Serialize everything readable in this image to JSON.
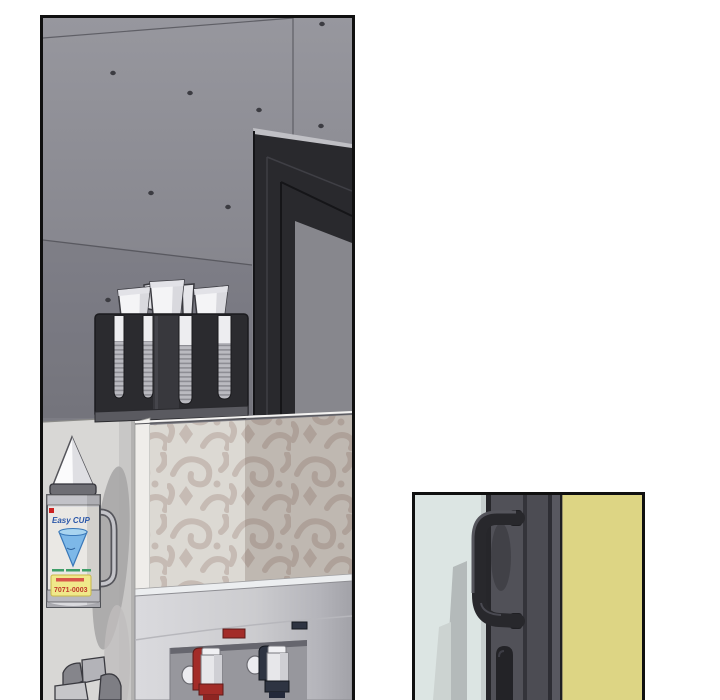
{
  "dispenser": {
    "brand": "Easy CUP",
    "phone": "7071-0003"
  },
  "colors": {
    "panel_border": "#101010",
    "concrete_top": "#97979e",
    "concrete_bottom": "#7b7b83",
    "lower_wall": "#d8d7d5",
    "door_frame_dark": "#29292d",
    "door_glass": "#87878d",
    "holder_dark": "#2b2b2f",
    "cup_white": "#f4f4f6",
    "rib_light": "#babac0",
    "rib_dark": "#8d8d94",
    "pattern_bg": "#dcd9d3",
    "pattern_motif": "#c6bbb4",
    "cooler_face_light": "#dadade",
    "cooler_face_dark": "#aeaeb4",
    "alcove_gray": "#97979d",
    "hot_red": "#a32c28",
    "cold_navy": "#2e3442",
    "right_glass": "#dce5e3",
    "right_frame": "#4a4a50",
    "handle_dark": "#28282c",
    "yellow_wall": "#ddd584",
    "label_blue": "#2a56a8",
    "sticker_yellow": "#f0e88a",
    "sticker_red": "#c0392b"
  }
}
